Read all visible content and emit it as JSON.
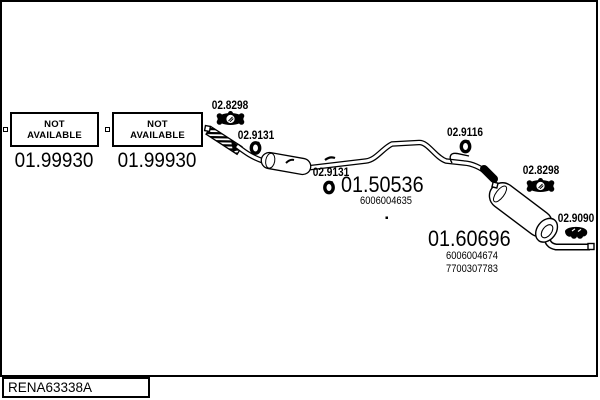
{
  "colors": {
    "ink": "#000000",
    "paper": "#ffffff"
  },
  "footer": {
    "drawing_code": "RENA63338A"
  },
  "not_available": [
    {
      "box_text": "NOT\nAVAILABLE",
      "ref": "01.99930"
    },
    {
      "box_text": "NOT\nAVAILABLE",
      "ref": "01.99930"
    }
  ],
  "labels": {
    "clamp_front": "02.8298",
    "ring_front": "02.9131",
    "ring_mid": "02.9131",
    "ring_rear": "02.9116",
    "clamp_rear": "02.8298",
    "hanger_rear": "02.9090"
  },
  "mid_silencer": {
    "ref": "01.50536",
    "oem": "6006004635"
  },
  "rear_silencer": {
    "ref": "01.60696",
    "oem_primary": "6006004674",
    "oem_secondary": "7700307783"
  }
}
